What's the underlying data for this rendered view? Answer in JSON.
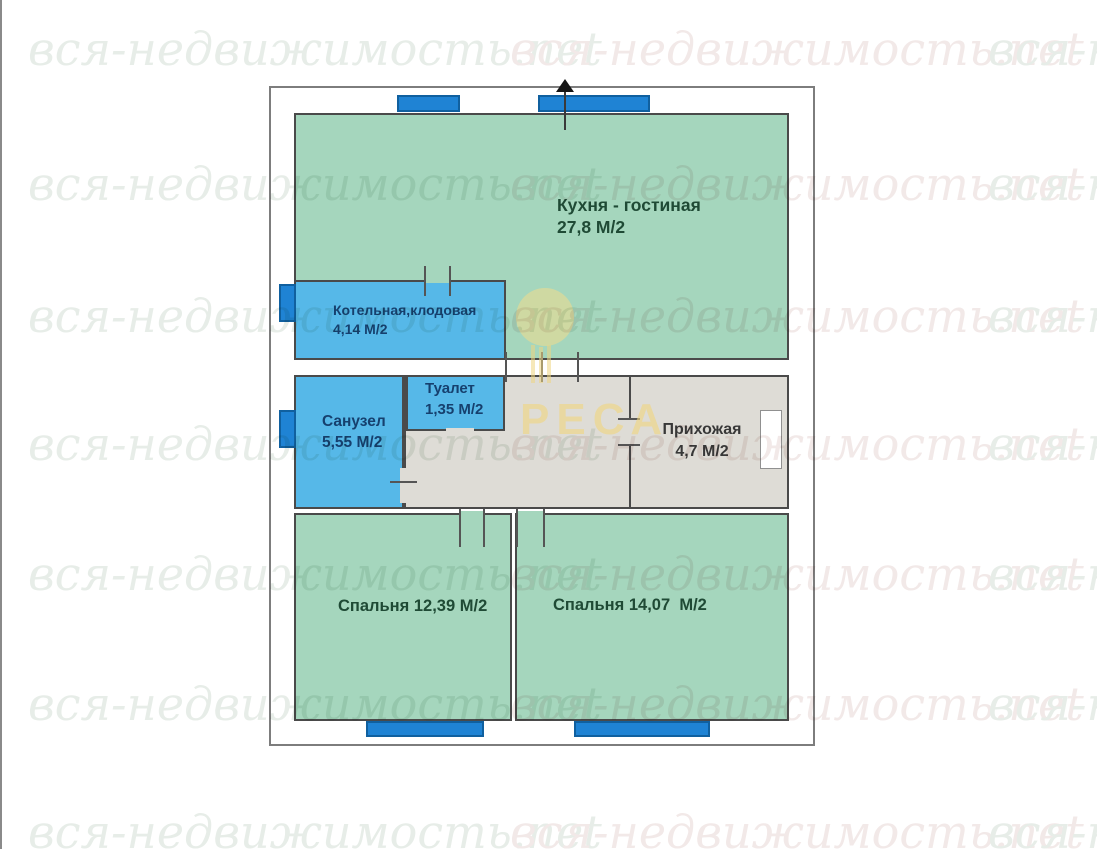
{
  "watermark": {
    "text": "вся-недвижимость.net",
    "brand": "РЕСА"
  },
  "rooms": {
    "kitchen": {
      "name": "Кухня - гостиная",
      "area": "27,8 М/2"
    },
    "boiler": {
      "name": "Котельная,клодовая",
      "area": "4,14 М/2"
    },
    "toilet": {
      "name": "Туалет",
      "area": "1,35 М/2"
    },
    "bathroom": {
      "name": "Санузел",
      "area": "5,55 М/2"
    },
    "hallway": {
      "name": "Прихожая",
      "area": "4,7 М/2"
    },
    "bedroom1": {
      "label": "Спальня 12,39 М/2"
    },
    "bedroom2": {
      "label": "Спальня 14,07  М/2"
    }
  },
  "colors": {
    "room_green": "#a5d6bd",
    "room_blue": "#56b8e8",
    "room_gray": "#dedcd6",
    "window_blue": "#1f83d4",
    "wall": "#4a4a4a",
    "label_green": "#1f4a35",
    "label_navy": "#16406e",
    "brand_yellow": "#f0d98e",
    "watermark_green": "#e7ede8",
    "watermark_red": "#f2e9e8"
  }
}
